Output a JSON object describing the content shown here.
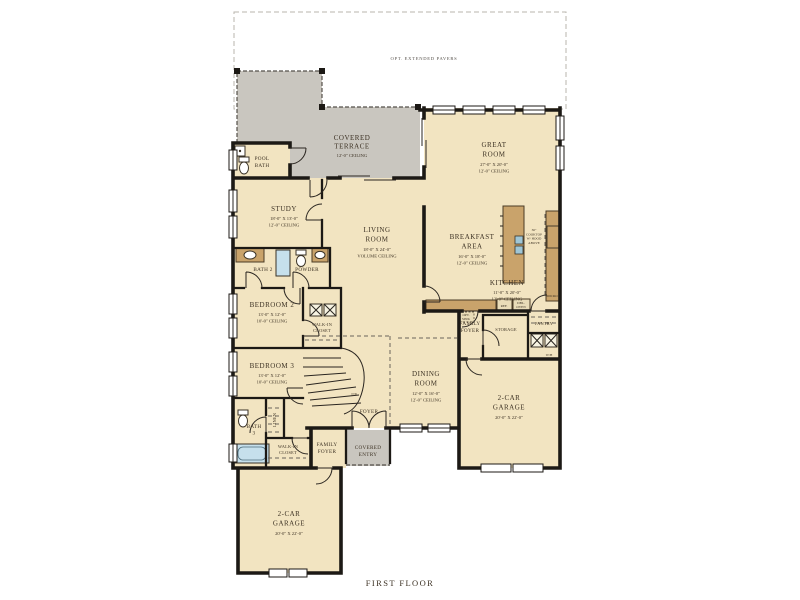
{
  "plan_title": "FIRST FLOOR",
  "colors": {
    "wall": "#1c1915",
    "room_fill": "#f2e4c1",
    "outdoor_fill": "#c9c6bf",
    "cabinet_fill": "#c9a36b",
    "fixture_blue": "#c6e0ec",
    "text": "#3c3123",
    "background": "#ffffff"
  },
  "outdoor": {
    "pavers_label": [
      "OPT. EXTENDED PAVERS"
    ],
    "terrace": {
      "name": [
        "COVERED",
        "TERRACE"
      ],
      "ceiling": [
        "12'-0\" CEILING"
      ]
    },
    "entry": {
      "name": [
        "COVERED",
        "ENTRY"
      ]
    }
  },
  "rooms": {
    "great_room": {
      "name": [
        "GREAT",
        "ROOM"
      ],
      "dims": [
        "27'-0\" X 20'-0\"",
        "12'-0\" CEILING"
      ]
    },
    "living_room": {
      "name": [
        "LIVING",
        "ROOM"
      ],
      "dims": [
        "18'-0\" X 24'-0\"",
        "VOLUME CEILING"
      ]
    },
    "study": {
      "name": [
        "STUDY"
      ],
      "dims": [
        "18'-0\" X 13'-0\"",
        "12'-0\" CEILING"
      ]
    },
    "breakfast_area": {
      "name": [
        "BREAKFAST",
        "AREA"
      ],
      "dims": [
        "16'-0\" X 18'-0\"",
        "12'-0\" CEILING"
      ]
    },
    "kitchen": {
      "name": [
        "KITCHEN"
      ],
      "dims": [
        "11'-0\" X 20'-0\"",
        "12'-0\" CEILING"
      ]
    },
    "dining_room": {
      "name": [
        "DINING",
        "ROOM"
      ],
      "dims": [
        "12'-0\" X 16'-0\"",
        "12'-0\" CEILING"
      ]
    },
    "pool_bath": {
      "name": [
        "POOL",
        "BATH"
      ]
    },
    "bath_2": {
      "name": [
        "BATH 2"
      ]
    },
    "powder": {
      "name": [
        "POWDER"
      ]
    },
    "bedroom_2": {
      "name": [
        "BEDROOM 2"
      ],
      "dims": [
        "13'-0\" X 12'-0\"",
        "10'-0\" CEILING"
      ]
    },
    "bedroom_3": {
      "name": [
        "BEDROOM 3"
      ],
      "dims": [
        "13'-0\" X 12'-0\"",
        "10'-0\" CEILING"
      ]
    },
    "walk_in_closet_2": {
      "name": [
        "WALK-IN",
        "CLOSET"
      ]
    },
    "walk_in_closet_3": {
      "name": [
        "WALK-IN",
        "CLOSET"
      ]
    },
    "bath_3": {
      "name": [
        "BATH",
        "3"
      ]
    },
    "linen": {
      "name": [
        "LINEN"
      ]
    },
    "family_foyer_a": {
      "name": [
        "FAMILY",
        "FOYER"
      ]
    },
    "family_foyer_b": {
      "name": [
        "FAMILY",
        "FOYER"
      ]
    },
    "foyer": {
      "name": [
        "FOYER"
      ]
    },
    "storage": {
      "name": [
        "STORAGE"
      ]
    },
    "pantry": {
      "name": [
        "PANTRY"
      ]
    },
    "garage_right": {
      "name": [
        "2-CAR",
        "GARAGE"
      ],
      "dims": [
        "20'-0\" X 22'-0\""
      ]
    },
    "garage_bottom": {
      "name": [
        "2-CAR",
        "GARAGE"
      ],
      "dims": [
        "20'-0\" X 22'-0\""
      ]
    }
  },
  "annotations": {
    "up": [
      "UP"
    ],
    "micro": [
      "MICRO"
    ],
    "wh": [
      "W/H"
    ],
    "ref": [
      "REF."
    ],
    "dbl_oven": [
      "DBL.",
      "OVEN"
    ],
    "opt_sink": [
      "OPT.",
      "SINK"
    ],
    "cooktop_note": [
      "36\"",
      "COOKTOP",
      "W/ HOOD",
      "ABOVE"
    ]
  },
  "footer": {
    "label": "FIRST FLOOR"
  }
}
